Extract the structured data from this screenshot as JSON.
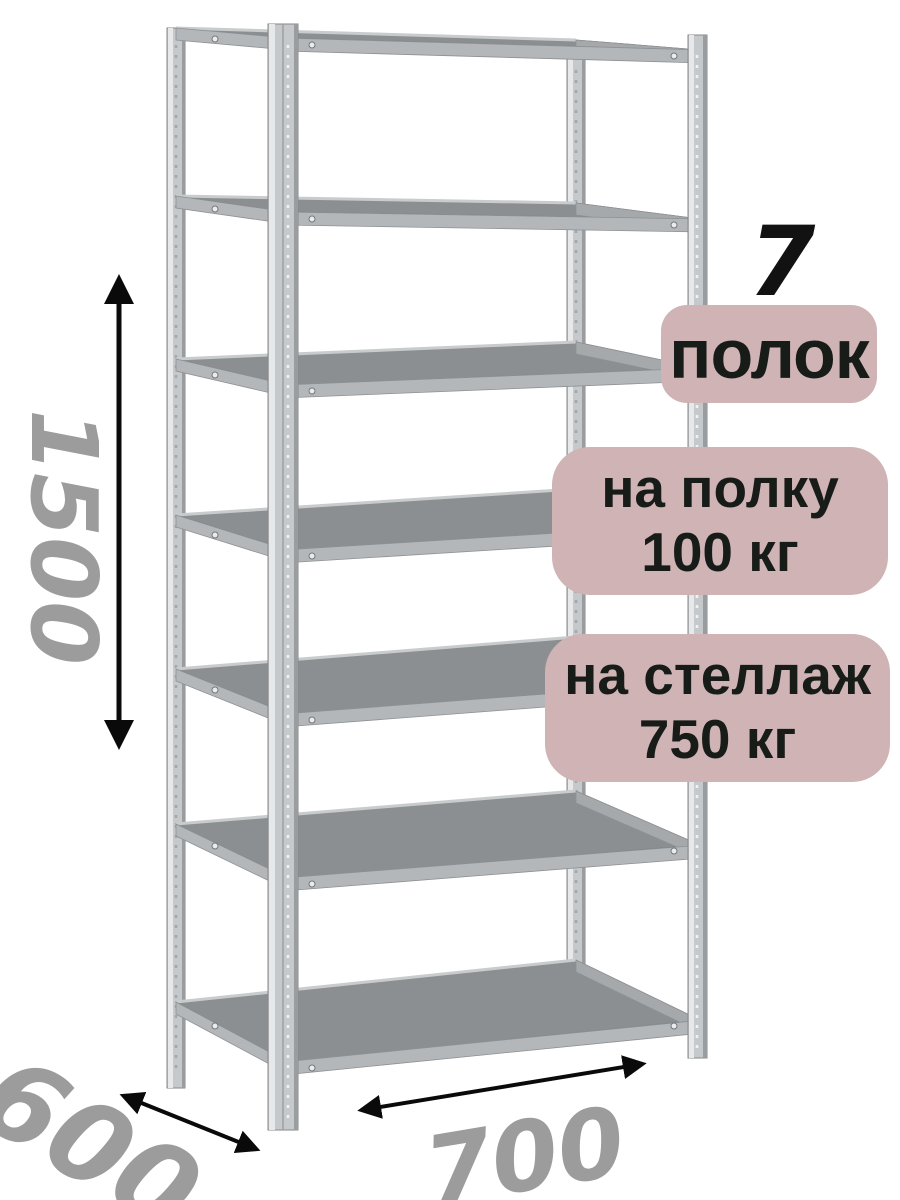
{
  "rack": {
    "shelf_count": 7,
    "post_count": 4
  },
  "dimensions": {
    "height": "1500",
    "depth": "600",
    "width": "700"
  },
  "callouts": {
    "shelf_count_number": "7",
    "shelf_count_caption": "полок",
    "per_shelf": {
      "line1": "на полку",
      "line2": "100 кг"
    },
    "per_rack": {
      "line1": "на стеллаж",
      "line2": "750 кг"
    }
  },
  "colors": {
    "badge_background": "#cfb3b5",
    "badge_text": "#181c18",
    "dimension_text": "#9c9c9c",
    "arrow": "#0a0a0a",
    "post_metal": "#c6c9cb",
    "post_highlight": "#e6e8e9",
    "post_shadow": "#9a9da0",
    "shelf_top": "#8c8f92",
    "shelf_band": "#b4b7b9"
  }
}
